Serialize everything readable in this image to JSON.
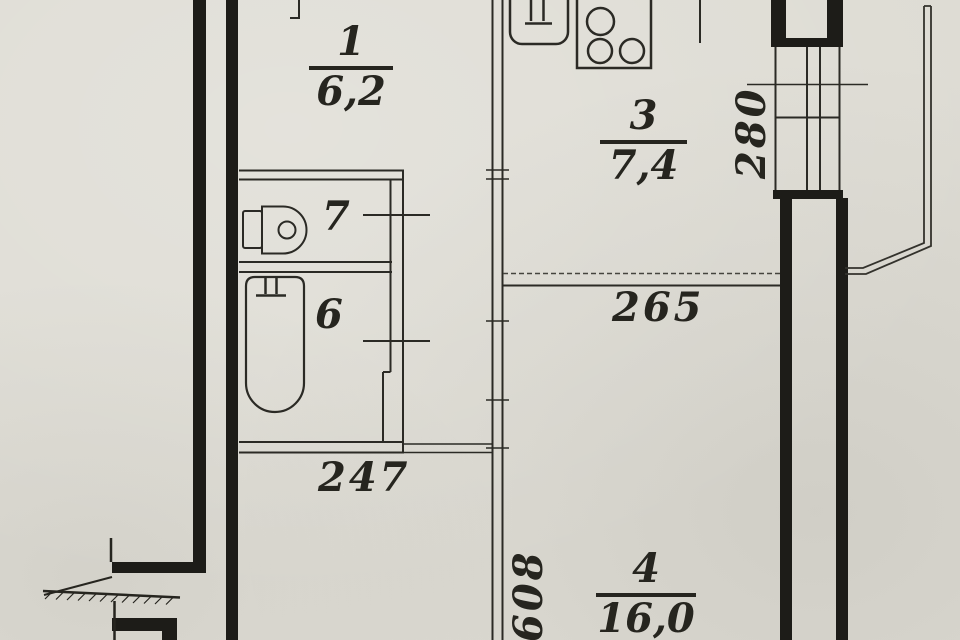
{
  "document": {
    "kind": "apartment floor plan (scanned BTI drawing)",
    "colors": {
      "paper": "#dedcd4",
      "ink": "#1d1c18"
    }
  },
  "rooms": {
    "hall": {
      "number": "1",
      "area": "6,2"
    },
    "kitchen": {
      "number": "3",
      "area": "7,4"
    },
    "living": {
      "number": "4",
      "area": "16,0"
    },
    "bath": {
      "number": "6"
    },
    "wc": {
      "number": "7"
    }
  },
  "dims": {
    "kitchen_depth": "280",
    "living_width": "265",
    "sanitary_block_width": "247",
    "living_length": "608"
  },
  "icons": [
    "sink-icon",
    "stove-icon",
    "toilet-icon",
    "bathtub-icon",
    "faucet-icon",
    "entrance-door-leaf",
    "stair-hatch-line",
    "balcony-outline"
  ]
}
